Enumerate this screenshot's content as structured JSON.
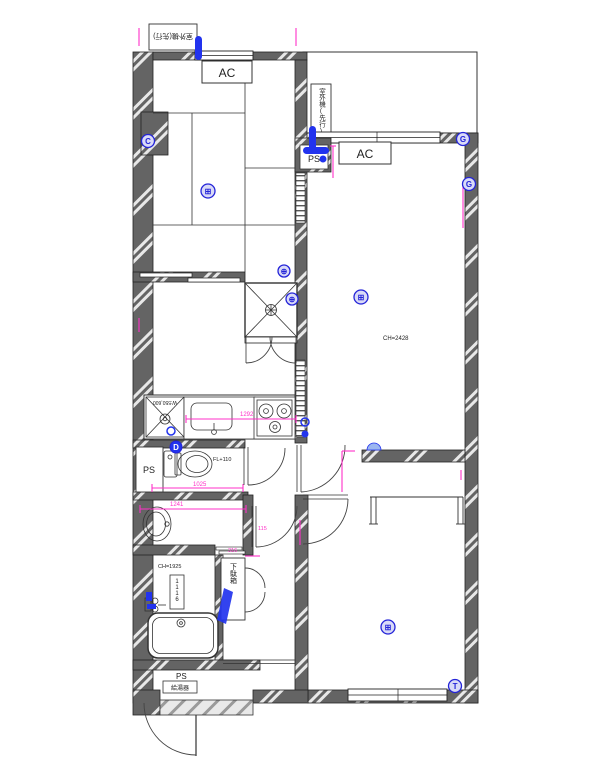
{
  "labels": {
    "ac_tatami": "AC",
    "ac_living": "AC",
    "outdoor_unit_top": "室外機(先行)",
    "outdoor_unit_balcony": "室外機(先行)",
    "ps_top": "PS",
    "ps_toilet": "PS",
    "ps_bottom": "PS",
    "water_heater": "給湯器",
    "shoe_cabinet": "下駄箱",
    "washer_space": "W:550,600",
    "bath_counter": "1116"
  },
  "measurements": {
    "living_ceiling": "CH=2428",
    "bath_ceiling": "CH=1925",
    "toilet_floor": "FL+110",
    "kitchen_counter": "1292",
    "vanity_width": "1241",
    "toilet_width": "1025",
    "entry_dim": "316",
    "hall_door": "115"
  },
  "markers": {
    "tatami_wall": "C",
    "tatami_center": "⊞",
    "living_top_right": "G",
    "right_wall": "G",
    "closet_top": "⊕",
    "closet_right": "⊕",
    "living_center": "⊞",
    "washer": "D",
    "toilet": "D",
    "bedroom_center": "⊞",
    "bedroom_corner": "T"
  },
  "colors": {
    "wall_gray": "#646464",
    "dimension_magenta": "#ff30c8",
    "marker_blue": "#2424d8",
    "accent_blue": "#2233ee"
  }
}
